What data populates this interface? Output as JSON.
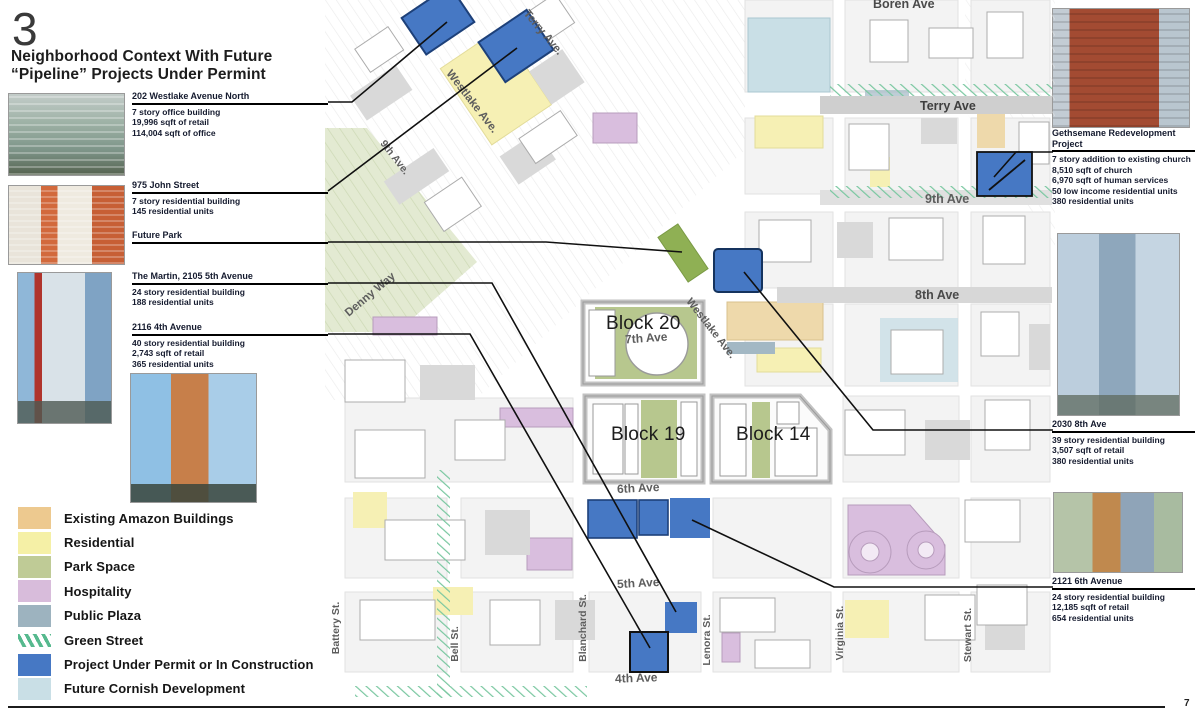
{
  "page": {
    "number": "3",
    "title_line1": "Neighborhood Context With Future",
    "title_line2": "“Pipeline” Projects Under Permint",
    "footer_page": "7"
  },
  "annotations": {
    "westlake202": {
      "title": "202 Westlake Avenue North",
      "lines": [
        "7 story office building",
        "19,996 sqft of retail",
        "114,004 sqft of office"
      ]
    },
    "john975": {
      "title": "975 John Street",
      "lines": [
        "7 story residential building",
        "145 residential units"
      ]
    },
    "future_park": {
      "title": "Future Park"
    },
    "martin": {
      "title": "The Martin, 2105 5th Avenue",
      "lines": [
        "24 story residential building",
        "188 residential units"
      ]
    },
    "ave2116": {
      "title": "2116 4th Avenue",
      "lines": [
        "40 story residential building",
        "2,743 sqft of retail",
        "365 residential units"
      ]
    },
    "gethsemane": {
      "title": "Gethsemane Redevelopment Project",
      "lines": [
        "7 story addition to existing church",
        "8,510 sqft of church",
        "6,970 sqft of human services",
        "50 low income residential units",
        "380 residential units"
      ]
    },
    "ave2030": {
      "title": "2030 8th Ave",
      "lines": [
        "39 story residential building",
        "3,507 sqft of retail",
        "380 residential units"
      ]
    },
    "ave2121": {
      "title": "2121 6th Avenue",
      "lines": [
        "24 story residential building",
        "12,185 sqft of retail",
        "654 residential units"
      ]
    }
  },
  "legend": {
    "items": [
      {
        "label": "Existing Amazon Buildings",
        "color": "#edc98f"
      },
      {
        "label": "Residential",
        "color": "#f5f0a6"
      },
      {
        "label": "Park Space",
        "color": "#bfcb96"
      },
      {
        "label": "Hospitality",
        "color": "#d8bcdb"
      },
      {
        "label": "Public Plaza",
        "color": "#9db3bf"
      },
      {
        "label": "Green Street",
        "color": "#56b98e",
        "style": "hatch"
      },
      {
        "label": "Project Under Permit or In Construction",
        "color": "#4678c4"
      },
      {
        "label": "Future Cornish Development",
        "color": "#c9dfe6"
      }
    ]
  },
  "map": {
    "streets": [
      "Boren Ave",
      "Terry Ave.",
      "Westlake Ave.",
      "9th Ave.",
      "Terry Ave",
      "9th Ave",
      "8th Ave",
      "Denny Way",
      "Westlake Ave.",
      "7th Ave",
      "6th Ave",
      "5th Ave",
      "4th Ave",
      "Battery St.",
      "Bell St.",
      "Blanchard St.",
      "Lenora St.",
      "Virginia St.",
      "Stewart St."
    ],
    "blocks": [
      "Block 20",
      "Block 19",
      "Block 14"
    ]
  }
}
